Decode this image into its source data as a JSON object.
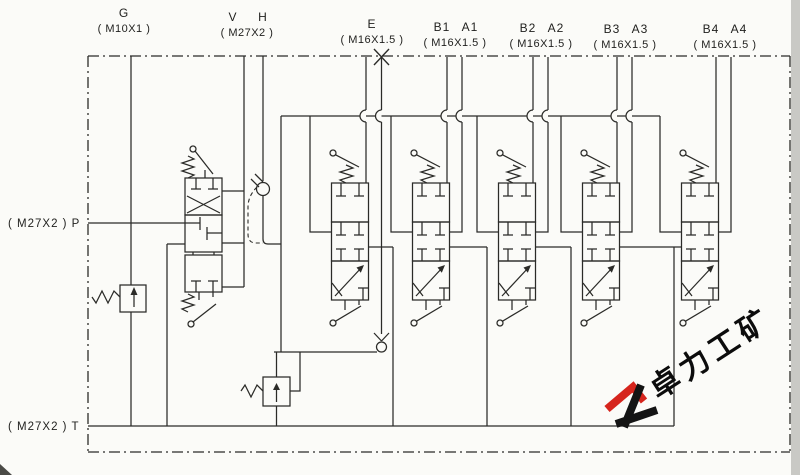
{
  "diagram": {
    "type": "hydraulic-multiway-valve-schematic",
    "ports": {
      "top": [
        {
          "b": "G",
          "a": "",
          "thread": "( M10X1 )"
        },
        {
          "b": "V",
          "a": "H",
          "thread": "( M27X2 )"
        },
        {
          "b": "E",
          "a": "",
          "thread": "( M16X1.5 )"
        },
        {
          "b": "B1",
          "a": "A1",
          "thread": "( M16X1.5 )"
        },
        {
          "b": "B2",
          "a": "A2",
          "thread": "( M16X1.5 )"
        },
        {
          "b": "B3",
          "a": "A3",
          "thread": "( M16X1.5 )"
        },
        {
          "b": "B4",
          "a": "A4",
          "thread": "( M16X1.5 )"
        }
      ],
      "left": {
        "p": "( M27X2 ) P",
        "t": "( M27X2 ) T"
      }
    },
    "line_color": "#2b2b28",
    "watermark": {
      "text": "卓力工矿",
      "logo_red": "#d6251d",
      "logo_black": "#141414"
    }
  }
}
